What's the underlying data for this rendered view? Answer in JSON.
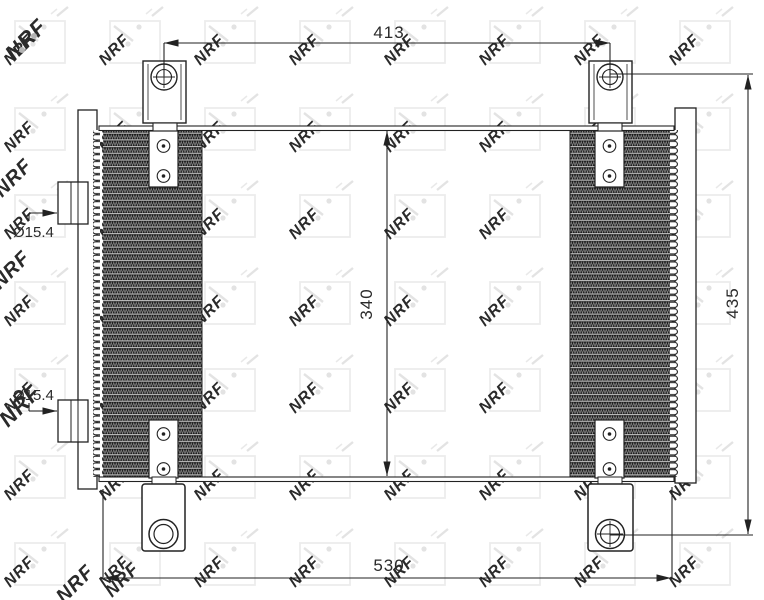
{
  "watermark": {
    "text": "NRF"
  },
  "labels": {
    "dim413": "413",
    "dim340": "340",
    "dim435": "435",
    "dim530": "530",
    "port_top": "Ø15.4",
    "port_bottom": "Ø15.4"
  },
  "colors": {
    "line": "#222222",
    "fin_dark": "#1b1b1b",
    "watermark_light": "#e2e2e2",
    "watermark_edge": "#aaaaaa",
    "background": "#ffffff"
  }
}
